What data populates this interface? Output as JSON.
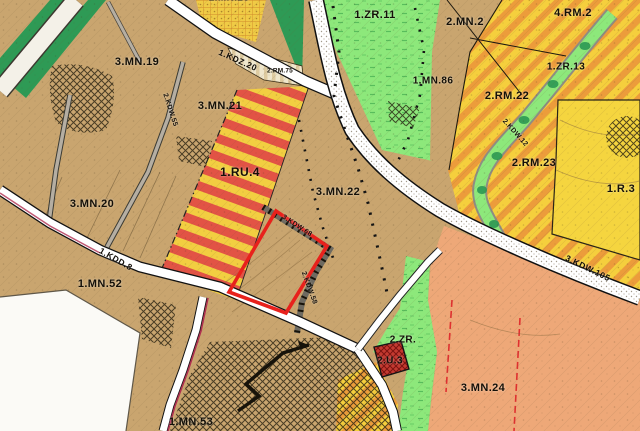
{
  "map": {
    "kind": "land-use zoning plan with selected parcel highlighted",
    "width_px": 640,
    "height_px": 431
  },
  "labels": {
    "zone_zr11": "1.ZR.11",
    "zone_mn2": "2.MN.2",
    "zone_rm2": "4.RM.2",
    "zone_mn25": "2.MN.25",
    "zone_mn19": "3.MN.19",
    "zone_mn86": "1.MN.86",
    "zone_zr13": "1.ZR.13",
    "zone_rm75": "2.RM.75",
    "zone_rm22": "2.RM.22",
    "zone_mn21": "3.MN.21",
    "zone_rm23": "2.RM.23",
    "zone_ru4": "1.RU.4",
    "zone_mn22": "3.MN.22",
    "zone_mn20": "3.MN.20",
    "zone_r3": "1.R.3",
    "zone_mn52": "1.MN.52",
    "zone_mn24": "3.MN.24",
    "zone_mn53": "1.MN.53",
    "zone_zr2": "2.ZR.",
    "zone_u3": "2.U.3",
    "road_kdz20": "1.KDZ.20",
    "road_kdd8": "1.KDD.8",
    "road_kdw55": "2.KDW.55",
    "road_kdw68": "3.KDW.68",
    "road_kdw58": "2.KDW.58",
    "road_kdw12": "2.KDW.12",
    "road_kdw105": "3.KDW.105"
  },
  "selection": {
    "outline_color": "#e8211c"
  },
  "palette": {
    "base_tan": "#c9a56f",
    "light_green_zr": "#8de87b",
    "dark_green": "#2e9a55",
    "field_yellow": "#f5d53f",
    "stripe_orange": "#ec9c3b",
    "stripe_red": "#e25345",
    "zone_orange": "#eea878",
    "parcel_red": "#c43a30",
    "road_white": "#ffffff",
    "out_of_plan_white": "#fbfaf6"
  }
}
